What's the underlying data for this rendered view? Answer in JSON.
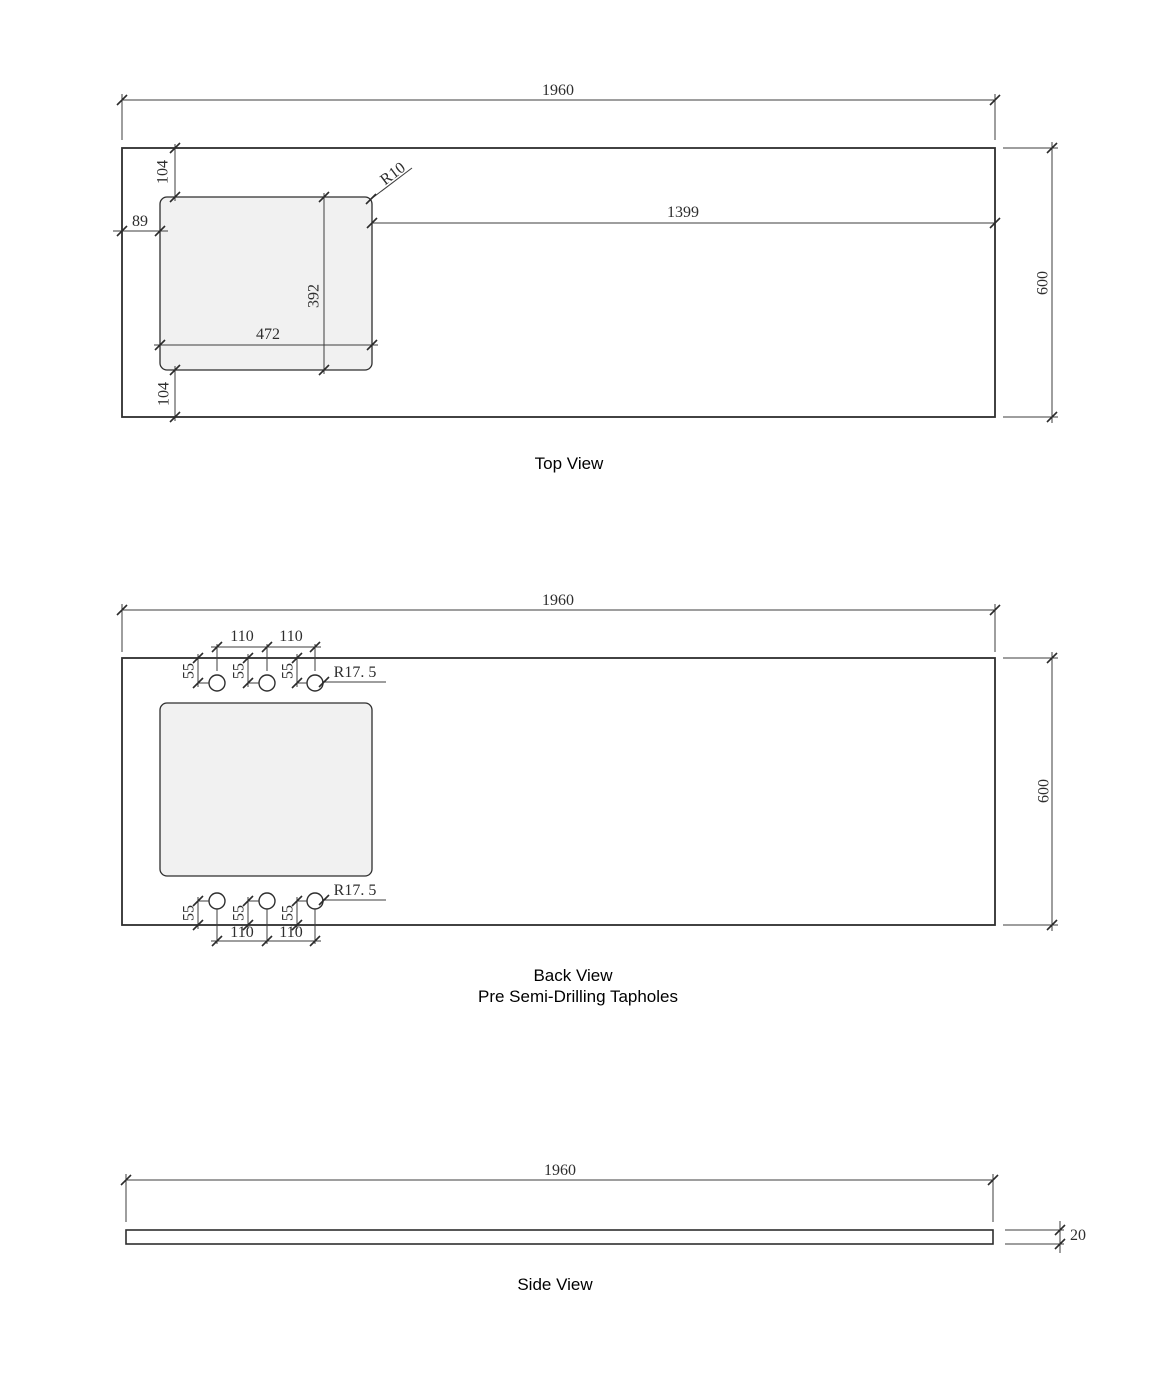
{
  "document": {
    "background": "#ffffff",
    "line_color": "#2e2e2e",
    "dim_color": "#3d3d3d",
    "cutout_fill": "#f1f1f1"
  },
  "views": {
    "top": {
      "label": "Top View",
      "dims": {
        "overall_width": "1960",
        "overall_depth": "600",
        "cutout_offset_top": "104",
        "cutout_offset_bottom": "104",
        "cutout_offset_left": "89",
        "cutout_width": "472",
        "cutout_depth": "392",
        "cutout_to_right_edge": "1399",
        "cutout_corner_radius": "R10"
      }
    },
    "back": {
      "label": "Back View",
      "sublabel": "Pre Semi-Drilling Tapholes",
      "dims": {
        "overall_width": "1960",
        "overall_depth": "600",
        "taphole_radius_top": "R17. 5",
        "taphole_radius_bottom": "R17. 5",
        "spacings_top": [
          "110",
          "110"
        ],
        "spacings_bottom": [
          "110",
          "110"
        ],
        "offsets_top": [
          "55",
          "55",
          "55"
        ],
        "offsets_bottom": [
          "55",
          "55",
          "55"
        ]
      }
    },
    "side": {
      "label": "Side View",
      "dims": {
        "overall_width": "1960",
        "thickness": "20"
      }
    }
  }
}
